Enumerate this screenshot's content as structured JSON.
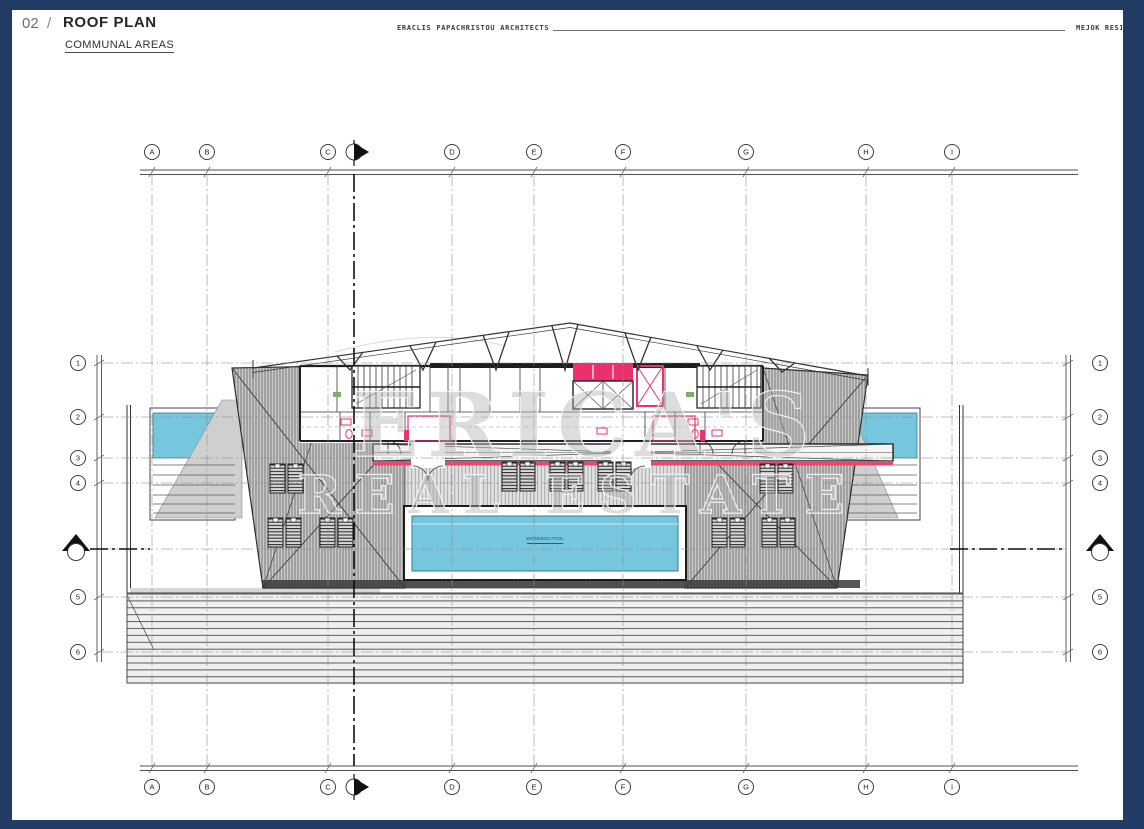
{
  "header": {
    "sheet_number": "02",
    "separator": "/",
    "title": "ROOF PLAN",
    "subtitle": "COMMUNAL AREAS",
    "architect": "ERACLIS PAPACHRISTOU ARCHITECTS",
    "project_partial": "MEJOK RESI"
  },
  "grid": {
    "column_labels": [
      "A",
      "B",
      "C",
      "D",
      "E",
      "F",
      "G",
      "H",
      "I"
    ],
    "column_x": [
      152,
      207,
      328,
      452,
      534,
      623,
      746,
      866,
      952
    ],
    "row_labels": [
      "1",
      "2",
      "3",
      "4",
      "5",
      "6"
    ],
    "row_y": [
      363,
      417,
      458,
      483,
      597,
      652
    ],
    "section_column_x": 354,
    "section_row_y": 549
  },
  "watermark": {
    "line1": "ERICA'S",
    "line2": "REAL ESTATE"
  },
  "plan": {
    "pool_label": "SWIMMING POOL"
  },
  "colors": {
    "frame_navy": "#223c66",
    "water_blue": "#76c6de",
    "accent_pink": "#e8356e",
    "hatch_gray": "#c9c9c9"
  }
}
